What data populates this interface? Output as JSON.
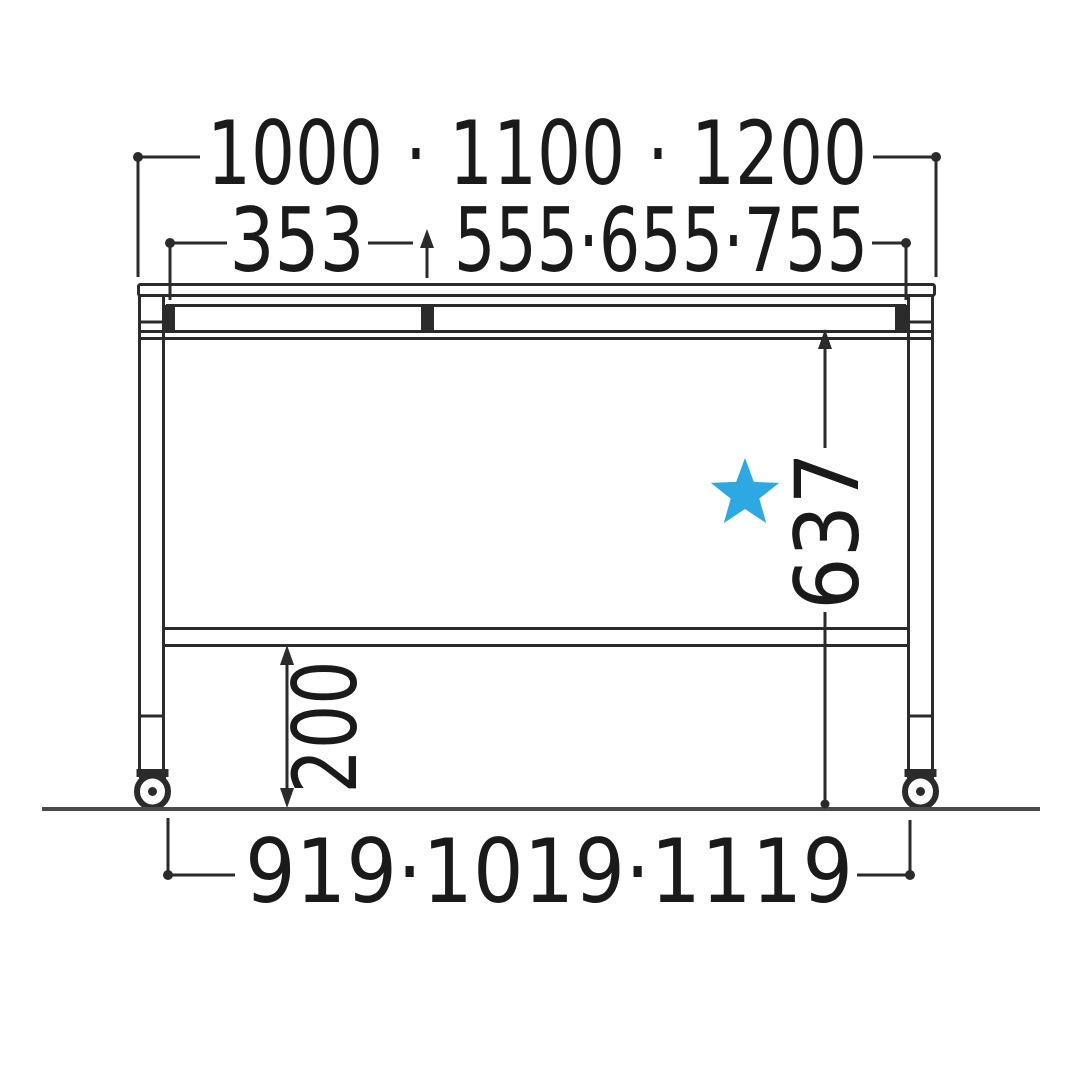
{
  "diagram": {
    "description": "Front elevation line drawing of a table on casters with dimension callouts",
    "colors": {
      "line": "#2b2b2b",
      "text": "#1a1a1a",
      "floor": "#4a4a4a",
      "star": "#2ea8e2",
      "background": "#ffffff"
    },
    "star_icon": "five-pointed-star",
    "dimensions": {
      "top_width": "1000 · 1100 · 1200",
      "left_section_width": "353",
      "right_section_width": "555·655·755",
      "frame_height": "637",
      "shelf_height": "200",
      "caster_span": "919·1019·1119"
    }
  }
}
